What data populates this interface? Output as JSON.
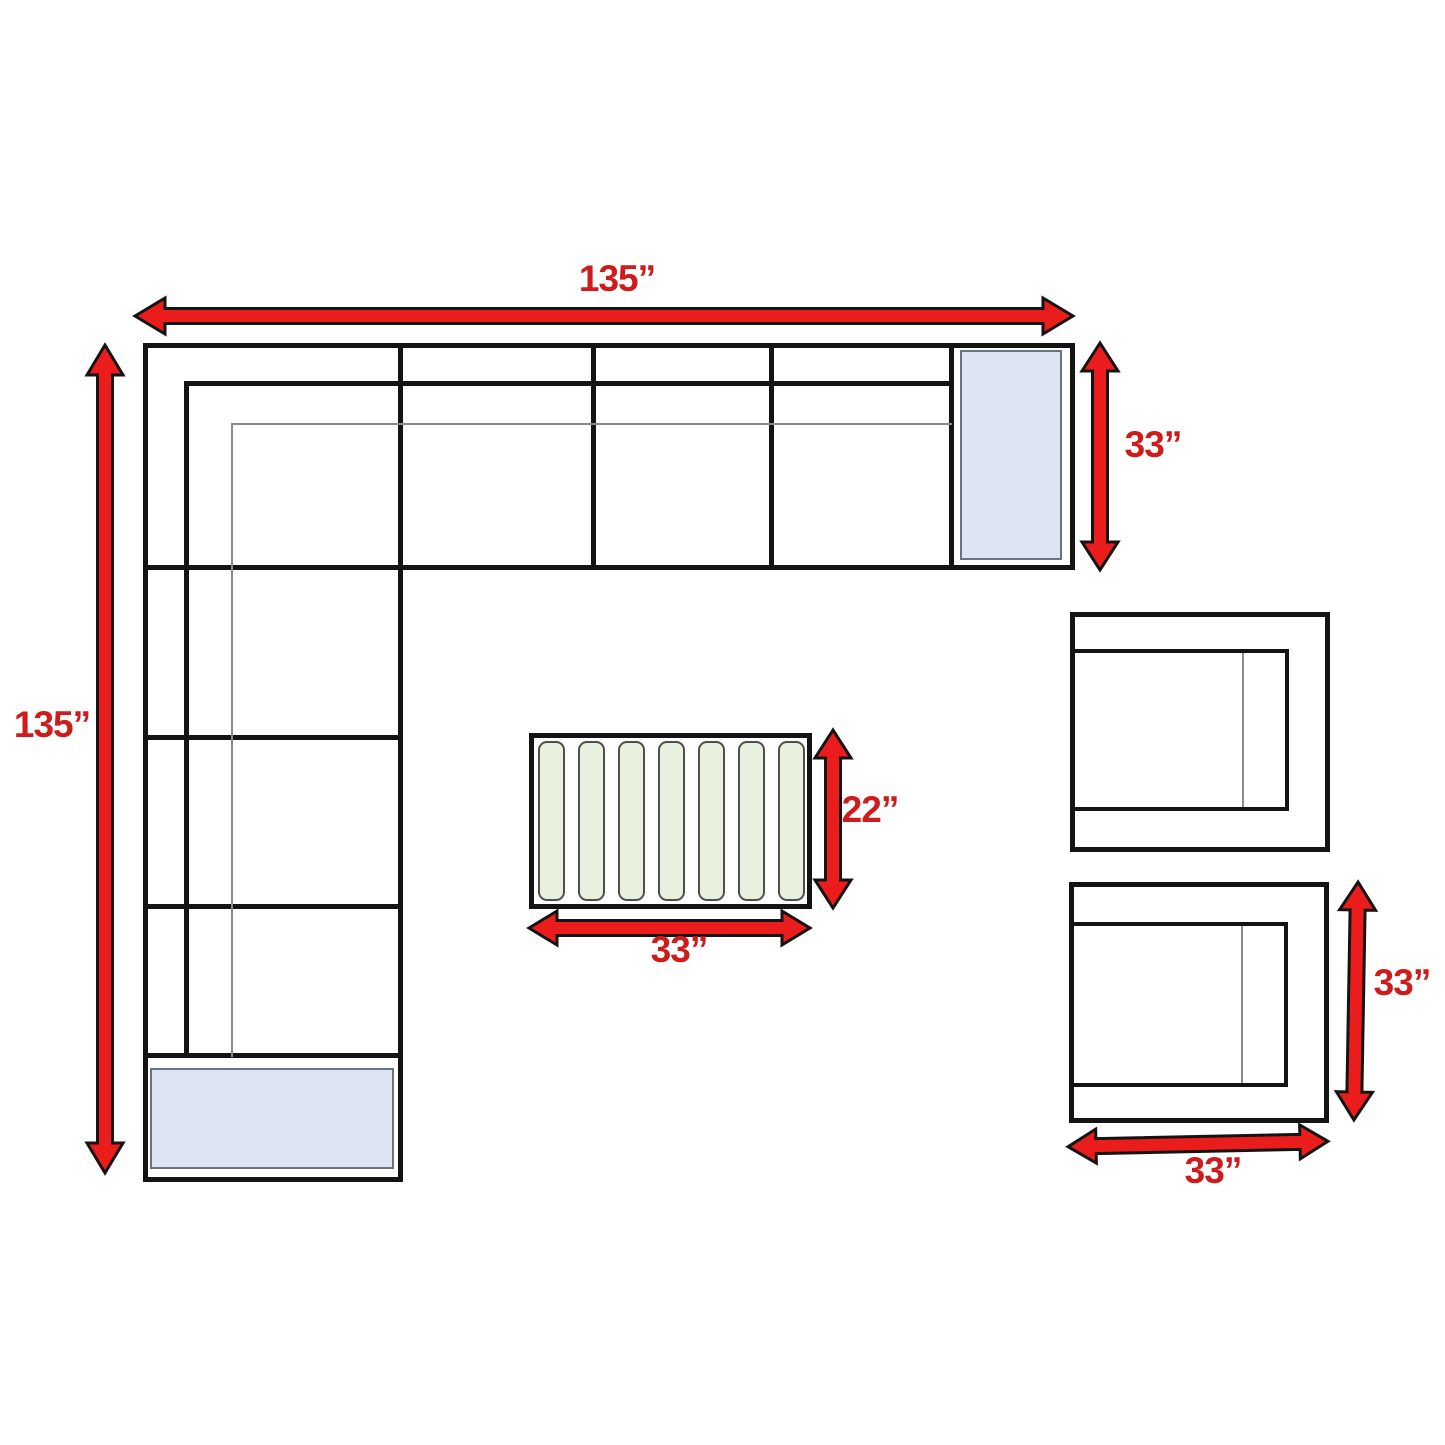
{
  "diagram": {
    "type": "furniture-dimension-floor-plan",
    "labels": {
      "sectional_width": "135”",
      "sectional_height": "135”",
      "sectional_depth": "33”",
      "coffee_table_depth": "22”",
      "coffee_table_width": "33”",
      "armchair_depth": "33”",
      "armchair_width": "33”"
    },
    "components": {
      "sectional": {
        "top_row_seat_sections": 3,
        "left_arm_seat_sections": 3,
        "corner_sections": 1,
        "end_tables": 2
      },
      "coffee_table": {
        "slats": 7
      },
      "armchairs": {
        "count": 2
      }
    },
    "colors": {
      "arrow_fill": "#ea1c1c",
      "arrow_outline": "#141414",
      "label_text": "#cf1b1b",
      "furniture_line": "#141414",
      "secondary_line": "#8a8a8a",
      "end_table_fill": "#dde4f2",
      "end_table_border": "#6b7280",
      "slat_fill": "#e8f0de",
      "slat_border": "#4f4f4f",
      "background": "#ffffff"
    }
  }
}
